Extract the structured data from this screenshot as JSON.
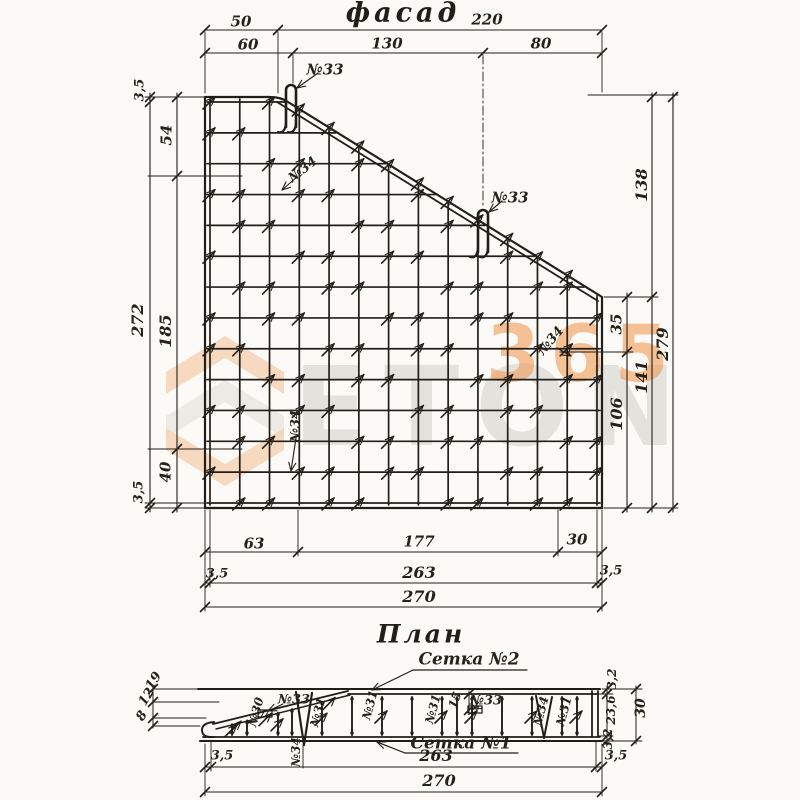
{
  "page": {
    "background": "#fbfaf6",
    "ink": "#211e1a"
  },
  "watermark": {
    "brand": "ETON",
    "number": "365",
    "brand_color": "#d2cfc9",
    "accent_color": "#f09a54"
  },
  "facade": {
    "title": "фасад",
    "labels": [
      {
        "n": "dim-top-50",
        "t": "50",
        "x": 241,
        "y": 22
      },
      {
        "n": "dim-top-220",
        "t": "220",
        "x": 487,
        "y": 20
      },
      {
        "n": "dim-top-60",
        "t": "60",
        "x": 248,
        "y": 45
      },
      {
        "n": "dim-top-130",
        "t": "130",
        "x": 387,
        "y": 44
      },
      {
        "n": "dim-top-80",
        "t": "80",
        "x": 541,
        "y": 44
      },
      {
        "n": "dim-left-3-5-top",
        "t": "3,5",
        "x": 140,
        "y": 90,
        "r": -90,
        "s": 13
      },
      {
        "n": "dim-left-54",
        "t": "54",
        "x": 167,
        "y": 135,
        "r": -90
      },
      {
        "n": "dim-left-272",
        "t": "272",
        "x": 138,
        "y": 320,
        "r": -90,
        "s": 16
      },
      {
        "n": "dim-left-185",
        "t": "185",
        "x": 166,
        "y": 331,
        "r": -90,
        "s": 16
      },
      {
        "n": "dim-left-40",
        "t": "40",
        "x": 166,
        "y": 472,
        "r": -90
      },
      {
        "n": "dim-left-3-5-bottom",
        "t": "3,5",
        "x": 139,
        "y": 492,
        "r": -90,
        "s": 13
      },
      {
        "n": "dim-right-138",
        "t": "138",
        "x": 642,
        "y": 185,
        "r": -90,
        "s": 16
      },
      {
        "n": "dim-right-35",
        "t": "35",
        "x": 617,
        "y": 324,
        "r": -90
      },
      {
        "n": "dim-right-279",
        "t": "279",
        "x": 663,
        "y": 344,
        "r": -90,
        "s": 16
      },
      {
        "n": "dim-right-141",
        "t": "141",
        "x": 642,
        "y": 377,
        "r": -90,
        "s": 16
      },
      {
        "n": "dim-right-106",
        "t": "106",
        "x": 617,
        "y": 414,
        "r": -90,
        "s": 16
      },
      {
        "n": "dim-bottom-63",
        "t": "63",
        "x": 254,
        "y": 544
      },
      {
        "n": "dim-bottom-177",
        "t": "177",
        "x": 419,
        "y": 542
      },
      {
        "n": "dim-bottom-30",
        "t": "30",
        "x": 577,
        "y": 540
      },
      {
        "n": "dim-bottom-3-5-left",
        "t": "3,5",
        "x": 217,
        "y": 574,
        "s": 13
      },
      {
        "n": "dim-bottom-263",
        "t": "263",
        "x": 419,
        "y": 573,
        "s": 16
      },
      {
        "n": "dim-bottom-3-5-right",
        "t": "3,5",
        "x": 611,
        "y": 571,
        "s": 13
      },
      {
        "n": "dim-bottom-270",
        "t": "270",
        "x": 419,
        "y": 597,
        "s": 16
      },
      {
        "n": "callout-n33-top",
        "t": "№33",
        "x": 325,
        "y": 70
      },
      {
        "n": "callout-n33-mid",
        "t": "№33",
        "x": 510,
        "y": 198
      },
      {
        "n": "callout-n34-upper",
        "t": "№34",
        "x": 303,
        "y": 170,
        "r": -38,
        "s": 13
      },
      {
        "n": "callout-n34-right",
        "t": "№34",
        "x": 551,
        "y": 341,
        "r": -50,
        "s": 13
      },
      {
        "n": "callout-n34-lower",
        "t": "№34",
        "x": 296,
        "y": 426,
        "r": -90,
        "s": 13
      }
    ]
  },
  "plan": {
    "title": "План",
    "labels": [
      {
        "n": "callout-mesh-2",
        "t": "Сетка №2",
        "x": 469,
        "y": 660,
        "s": 17
      },
      {
        "n": "callout-mesh-1",
        "t": "Сетка №1",
        "x": 461,
        "y": 744,
        "s": 17
      },
      {
        "n": "dim-plan-left-19",
        "t": "19",
        "x": 154,
        "y": 681,
        "r": -58,
        "s": 13
      },
      {
        "n": "dim-plan-left-12",
        "t": "12",
        "x": 147,
        "y": 697,
        "r": -58,
        "s": 13
      },
      {
        "n": "dim-plan-left-8",
        "t": "8",
        "x": 142,
        "y": 716,
        "r": -58,
        "s": 13
      },
      {
        "n": "callout-n30",
        "t": "№30",
        "x": 256,
        "y": 712,
        "r": -75,
        "s": 12
      },
      {
        "n": "callout-n33-plan-left",
        "t": "№33",
        "x": 294,
        "y": 700,
        "s": 13
      },
      {
        "n": "callout-n34-plan-left",
        "t": "№34",
        "x": 296,
        "y": 752,
        "r": -90,
        "s": 12
      },
      {
        "n": "callout-n31-1",
        "t": "№31",
        "x": 318,
        "y": 712,
        "r": -75,
        "s": 12
      },
      {
        "n": "callout-n31-2",
        "t": "№31",
        "x": 370,
        "y": 705,
        "r": -75,
        "s": 12
      },
      {
        "n": "callout-n31-3",
        "t": "№31",
        "x": 433,
        "y": 709,
        "r": -75,
        "s": 12
      },
      {
        "n": "dim-plan-15",
        "t": "15",
        "x": 455,
        "y": 700,
        "r": -70,
        "s": 12
      },
      {
        "n": "callout-n33-plan-right",
        "t": "№33",
        "x": 486,
        "y": 701,
        "s": 13
      },
      {
        "n": "callout-n34-plan-right",
        "t": "№34",
        "x": 541,
        "y": 711,
        "r": -75,
        "s": 12
      },
      {
        "n": "callout-n31-4",
        "t": "№31",
        "x": 564,
        "y": 711,
        "r": -75,
        "s": 12
      },
      {
        "n": "dim-plan-right-3-2-top",
        "t": "3,2",
        "x": 612,
        "y": 679,
        "r": -90,
        "s": 12
      },
      {
        "n": "dim-plan-right-23-6",
        "t": "23,6",
        "x": 611,
        "y": 710,
        "r": -90,
        "s": 12
      },
      {
        "n": "dim-plan-right-3-2-bottom",
        "t": "3,2",
        "x": 608,
        "y": 739,
        "r": -90,
        "s": 12
      },
      {
        "n": "dim-plan-right-30",
        "t": "30",
        "x": 641,
        "y": 708,
        "r": -90,
        "s": 14
      },
      {
        "n": "dim-plan-bottom-3-5-left",
        "t": "3,5",
        "x": 222,
        "y": 756,
        "s": 13
      },
      {
        "n": "dim-plan-bottom-263",
        "t": "263",
        "x": 436,
        "y": 756,
        "s": 16
      },
      {
        "n": "dim-plan-bottom-3-5-right",
        "t": "3,5",
        "x": 616,
        "y": 756,
        "s": 13
      },
      {
        "n": "dim-plan-bottom-270",
        "t": "270",
        "x": 439,
        "y": 781,
        "s": 16
      }
    ]
  }
}
